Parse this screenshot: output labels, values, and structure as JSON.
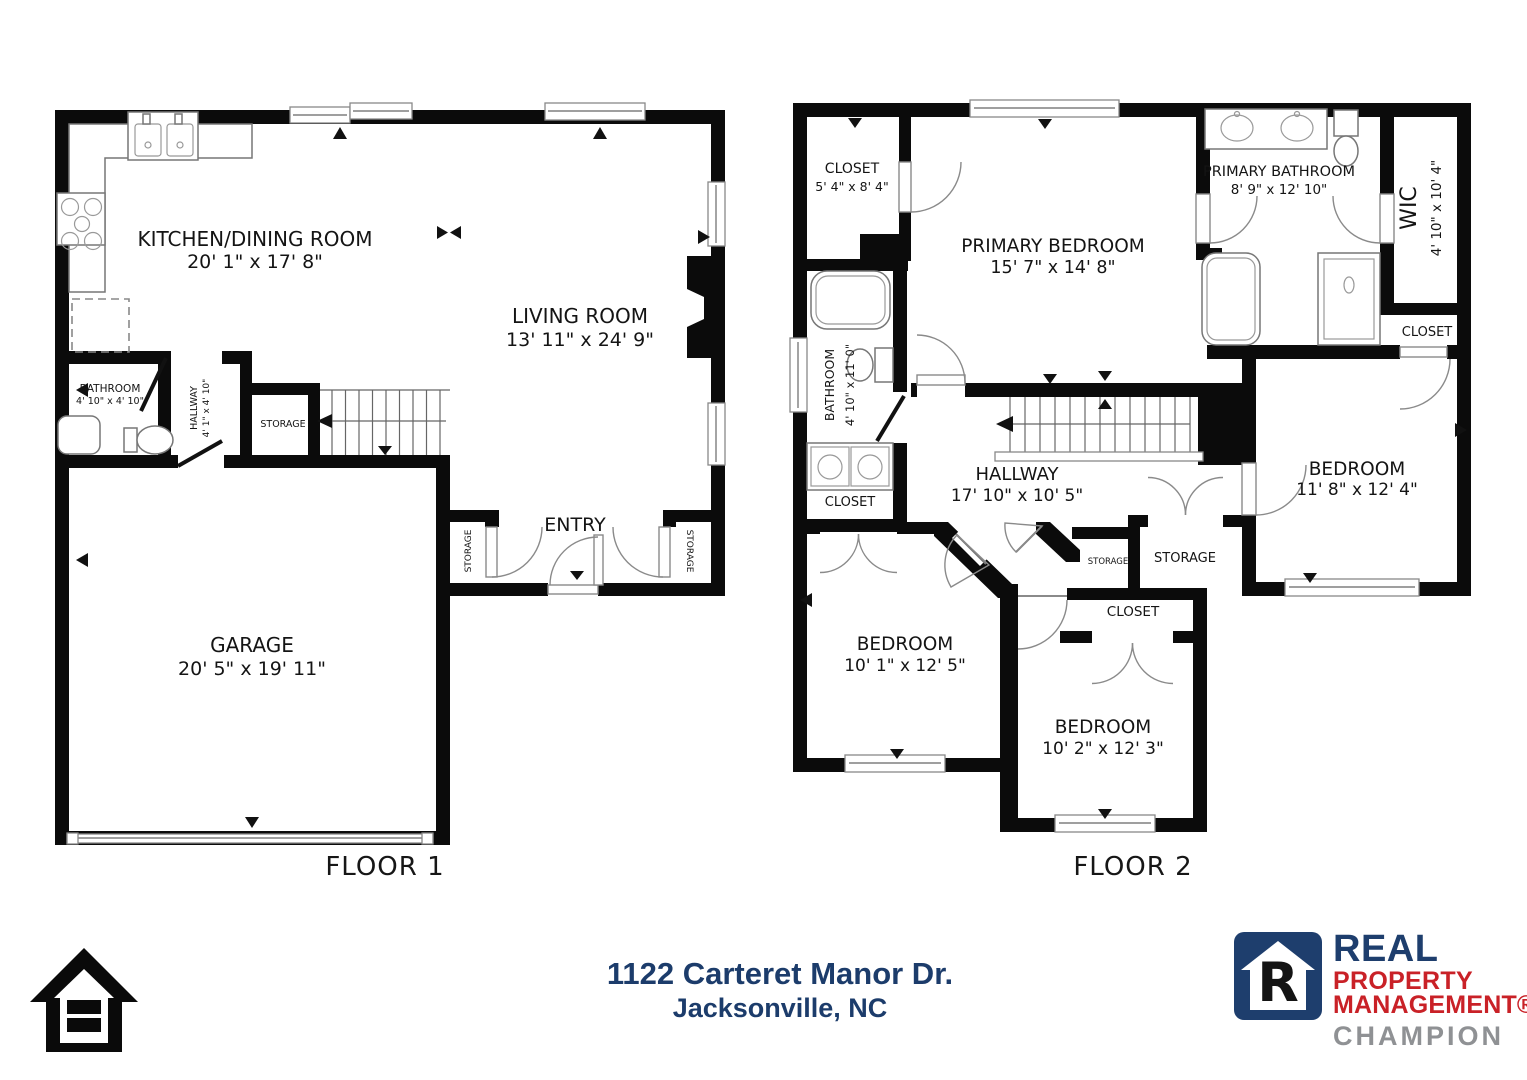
{
  "floor1": {
    "title": "FLOOR 1",
    "kitchen_name": "KITCHEN/DINING ROOM",
    "kitchen_dims": "20' 1\" x 17' 8\"",
    "living_name": "LIVING ROOM",
    "living_dims": "13' 11\" x 24' 9\"",
    "bathroom_name": "BATHROOM",
    "bathroom_dims": "4' 10\" x 4' 10\"",
    "hallway_name": "HALLWAY",
    "hallway_dims": "4' 1\" x 4' 10\"",
    "storage_label": "STORAGE",
    "garage_name": "GARAGE",
    "garage_dims": "20' 5\" x 19' 11\"",
    "entry_label": "ENTRY",
    "storage_left": "STORAGE",
    "storage_right": "STORAGE"
  },
  "floor2": {
    "title": "FLOOR 2",
    "closet_tl_name": "CLOSET",
    "closet_tl_dims": "5' 4\" x 8' 4\"",
    "primary_bedroom_name": "PRIMARY BEDROOM",
    "primary_bedroom_dims": "15' 7\" x 14' 8\"",
    "primary_bathroom_name": "PRIMARY BATHROOM",
    "primary_bathroom_dims": "8' 9\" x 12' 10\"",
    "wic_name": "WIC",
    "wic_dims": "4' 10\" x 10' 4\"",
    "closet_wic": "CLOSET",
    "bathroom_name": "BATHROOM",
    "bathroom_dims": "4' 10\" x 11' 0\"",
    "closet_left": "CLOSET",
    "hallway_name": "HALLWAY",
    "hallway_dims": "17' 10\" x 10' 5\"",
    "bedroom_right_name": "BEDROOM",
    "bedroom_right_dims": "11' 8\" x 12' 4\"",
    "storage_small": "STORAGE",
    "storage_big": "STORAGE",
    "closet_mid": "CLOSET",
    "bedroom_left_name": "BEDROOM",
    "bedroom_left_dims": "10' 1\" x 12' 5\"",
    "bedroom_bottom_name": "BEDROOM",
    "bedroom_bottom_dims": "10' 2\" x 12' 3\""
  },
  "footer": {
    "address_line1": "1122 Carteret Manor Dr.",
    "address_line2": "Jacksonville, NC",
    "logo": {
      "letter": "R",
      "line1": "REAL",
      "line2": "PROPERTY",
      "line3": "MANAGEMENT®",
      "line4": "CHAMPION"
    },
    "colors": {
      "navy": "#1e3e6d",
      "red": "#c92127",
      "gray": "#8f9194",
      "wall_black": "#0b0b0b"
    }
  }
}
